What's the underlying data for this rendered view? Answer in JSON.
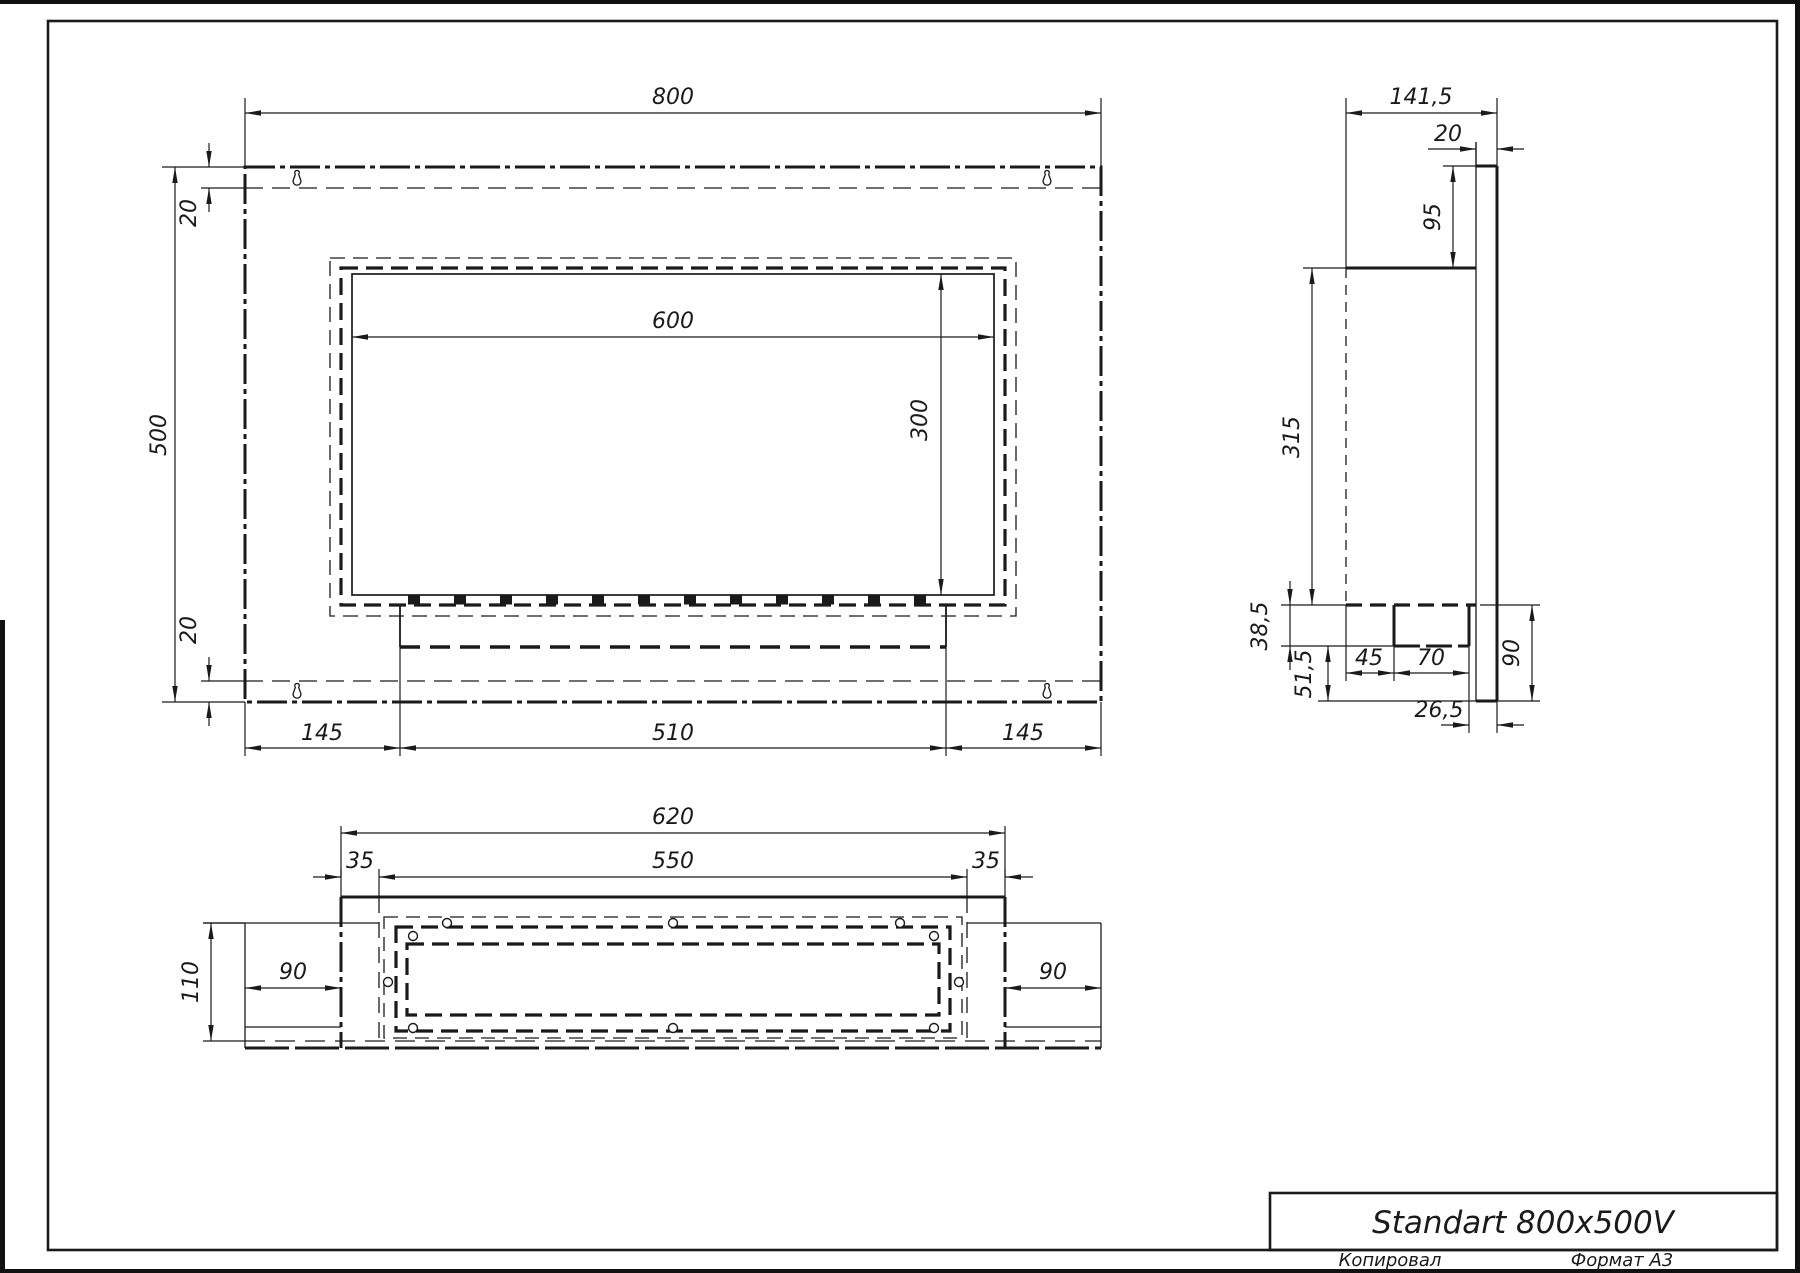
{
  "views": {
    "front": {
      "width": "800",
      "height": "500",
      "top_margin": "20",
      "bottom_margin": "20",
      "opening_width": "600",
      "opening_height": "300",
      "left_offset": "145",
      "shelf_width": "510",
      "right_offset": "145"
    },
    "side": {
      "depth": "141,5",
      "plate_thickness": "20",
      "top_offset": "95",
      "body_height": "315",
      "burner_drop": "38,5",
      "bottom_gap": "51,5",
      "foot_offset": "45",
      "foot_depth": "70",
      "back_gap": "26,5",
      "plate_drop": "90"
    },
    "bottom": {
      "body_width": "620",
      "cavity_width": "550",
      "wall_left": "35",
      "wall_right": "35",
      "wing_left": "90",
      "wing_right": "90",
      "depth": "110"
    }
  },
  "title_block": {
    "title": "Standart 800x500V"
  },
  "footer": {
    "copied": "Копировал",
    "format": "Формат А3"
  }
}
